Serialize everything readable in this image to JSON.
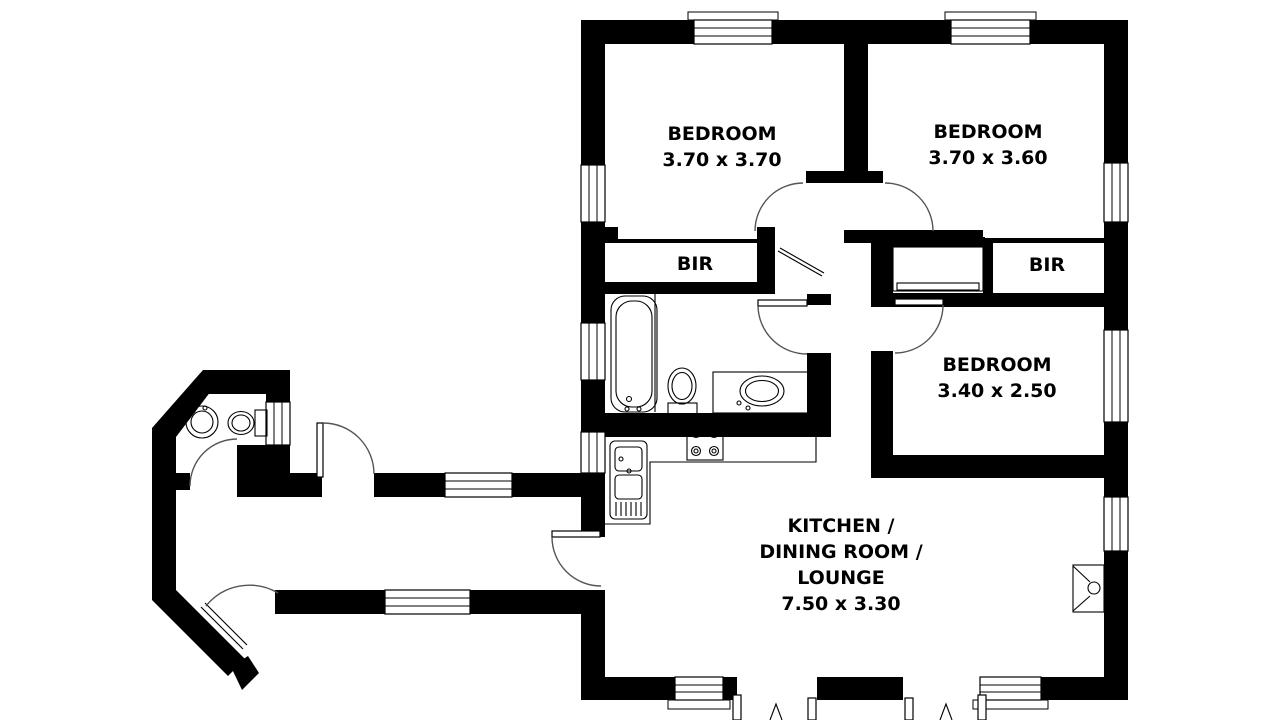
{
  "plan_title": "3 bedroom house floor plan",
  "rooms": {
    "bedroom1": {
      "name": "BEDROOM",
      "dims": "3.70 x 3.70"
    },
    "bedroom2": {
      "name": "BEDROOM",
      "dims": "3.70 x 3.60"
    },
    "bedroom3": {
      "name": "BEDROOM",
      "dims": "3.40 x 2.50"
    },
    "bir1": {
      "name": "BIR"
    },
    "bir2": {
      "name": "BIR"
    },
    "living": {
      "line1": "KITCHEN /",
      "line2": "DINING ROOM /",
      "line3": "LOUNGE",
      "dims": "7.50 x 3.30"
    }
  },
  "colors": {
    "wall": "#000000",
    "background": "#ffffff",
    "door_arc": "#555555"
  }
}
